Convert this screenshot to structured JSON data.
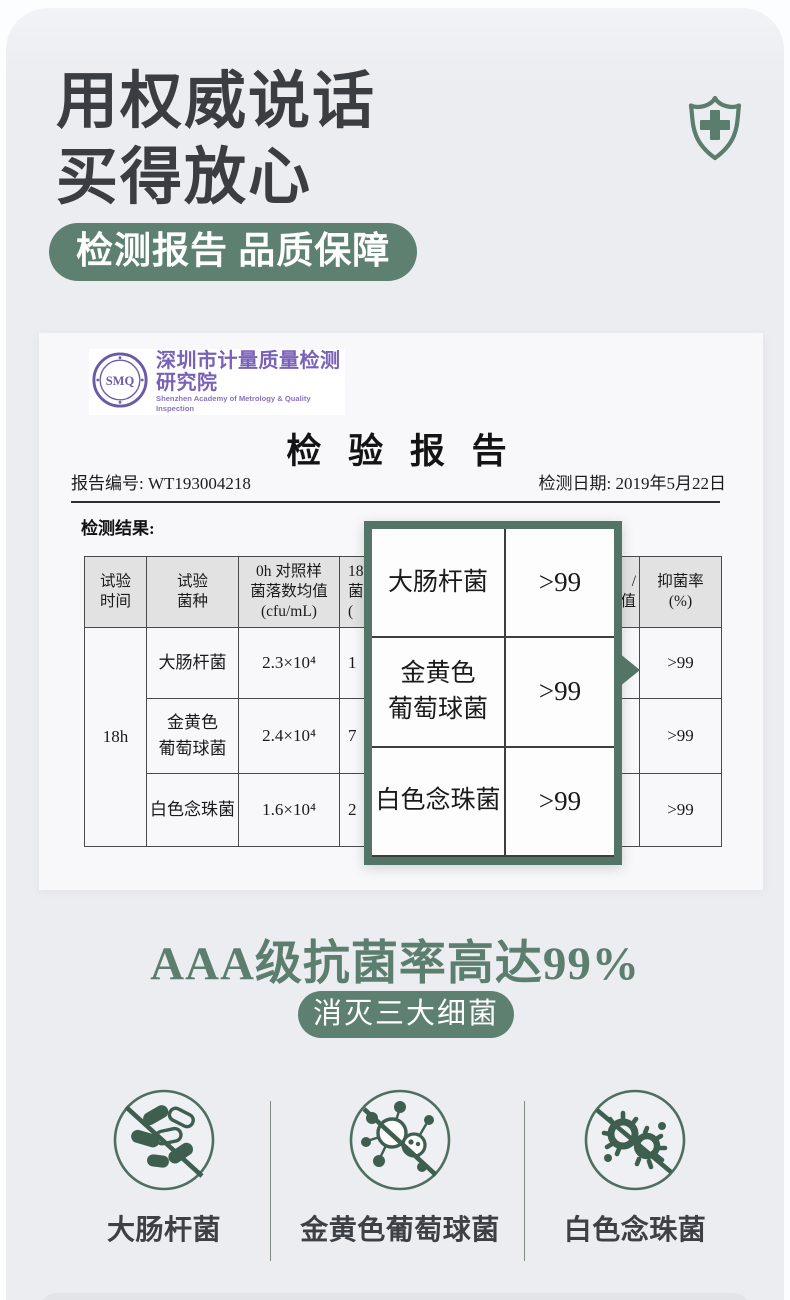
{
  "hero": {
    "title_line1": "用权威说话",
    "title_line2": "买得放心",
    "badge_label": "检测报告 品质保障"
  },
  "report": {
    "logo": {
      "seal_text": "SMQ",
      "agency_cn": "深圳市计量质量检测研究院",
      "agency_en": "Shenzhen Academy of Metrology & Quality Inspection"
    },
    "title": "检 验 报 告",
    "report_no": "报告编号: WT193004218",
    "test_date": "检测日期: 2019年5月22日",
    "results_label": "检测结果:",
    "table": {
      "header": {
        "col1": [
          "试验",
          "时间"
        ],
        "col2": [
          "试验",
          "菌种"
        ],
        "col3": [
          "0h 对照样",
          "菌落数均值",
          "(cfu/mL)"
        ],
        "col4_partial": [
          "18",
          "菌",
          "("
        ],
        "col5_partial": [
          "/",
          "值"
        ],
        "col6": [
          "抑菌率",
          "(%)"
        ]
      },
      "time_cell": "18h",
      "rows": [
        {
          "species_lines": [
            "大肠杆菌"
          ],
          "count_0h": "2.3×10⁴",
          "col4_partial": "1",
          "rate": ">99"
        },
        {
          "species_lines": [
            "金黄色",
            "葡萄球菌"
          ],
          "count_0h": "2.4×10⁴",
          "col4_partial": "7",
          "rate": ">99"
        },
        {
          "species_lines": [
            "白色念珠菌"
          ],
          "count_0h": "1.6×10⁴",
          "col4_partial": "2",
          "rate": ">99"
        }
      ]
    }
  },
  "magnifier": {
    "rows": [
      {
        "name_lines": [
          "大肠杆菌"
        ],
        "value": ">99"
      },
      {
        "name_lines": [
          "金黄色",
          "葡萄球菌"
        ],
        "value": ">99"
      },
      {
        "name_lines": [
          "白色念珠菌"
        ],
        "value": ">99"
      }
    ]
  },
  "summary": {
    "headline": "AAA级抗菌率高达99%",
    "badge_label": "消灭三大细菌",
    "bacteria": [
      {
        "label": "大肠杆菌"
      },
      {
        "label": "金黄色葡萄球菌"
      },
      {
        "label": "白色念珠菌"
      }
    ]
  },
  "colors": {
    "accent_green": "#5d8070",
    "deep_green": "#527568",
    "headline_green": "#5c7e6e",
    "dark_text": "#3a3d41",
    "seal_purple": "#6b5ba7",
    "table_header_bg": "#e2e2e2"
  }
}
